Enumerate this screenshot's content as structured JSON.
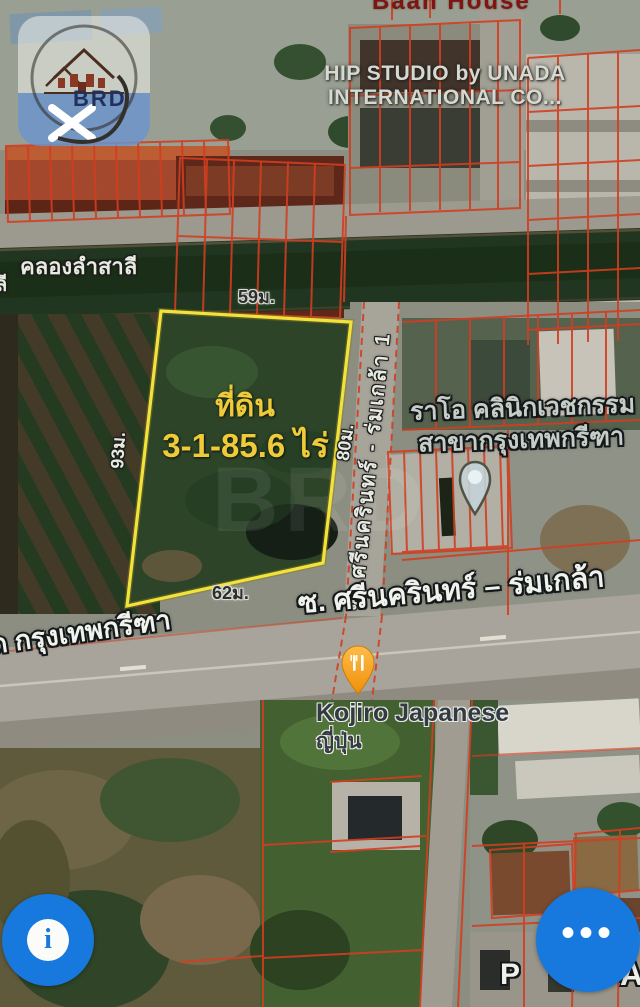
{
  "header": {
    "cropped_label": "Baan House",
    "credit_line1": "HIP STUDIO by UNADA",
    "credit_line2": "INTERNATIONAL  CO...",
    "logo_text": "BRD"
  },
  "map": {
    "canal_label": "คลองลำสาลี",
    "canal_label_fragment": "ลี",
    "plot": {
      "title": "ที่ดิน",
      "area": "3-1-85.6 ไร่",
      "side_top": "59ม.",
      "side_left": "93ม.",
      "side_right": "80ม.",
      "side_bottom": "62ม."
    },
    "roads": {
      "soi_vertical": "ซ. ศรีนครินทร์ - ร่มเกล้า 1",
      "soi_main": "ซ. ศรีนครินทร์ – ร่มเกล้า",
      "main_road": "ด กรุงเทพกรีฑา"
    },
    "places": {
      "clinic_line1": "ราโอ คลินิกเวชกรรม",
      "clinic_line2": "สาขากรุงเทพกรีฑา",
      "restaurant_name": "Kojiro Japanese",
      "restaurant_sub": "ญี่ปุ่น"
    },
    "fragments": {
      "bottom_left": "P",
      "bottom_right": "A"
    }
  },
  "controls": {
    "info_label": "i",
    "more_label": "•••"
  },
  "colors": {
    "parcel_line": "#d93d1e",
    "plot_outline": "#f2e23c",
    "plot_label": "#efcb3a",
    "button_blue": "#1779dd",
    "restaurant_pin": "#f59e12"
  }
}
